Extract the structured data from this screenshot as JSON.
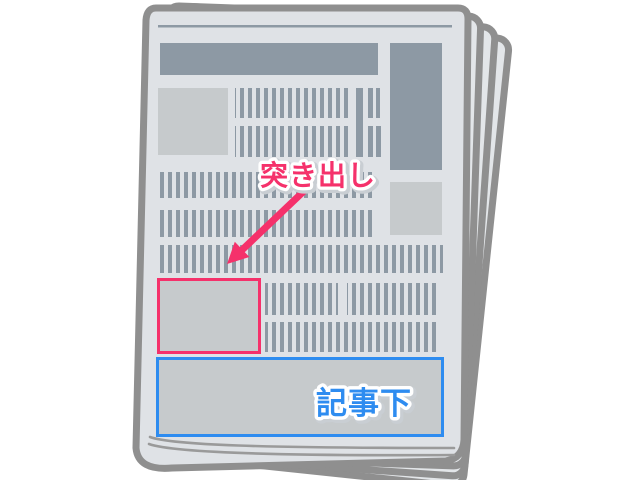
{
  "illustration": {
    "background_color": "#ffffff",
    "newspaper": {
      "paper_color": "#dfe2e6",
      "back_page_color": "#e3e6e9",
      "outline_color": "#8f8f8f",
      "ink_color": "#8d99a4",
      "image_block_color": "#c6cacc",
      "fold_line_color": "#9a9a9a"
    },
    "ad_slots": {
      "tsukidashi": {
        "label": "突き出し",
        "accent_color": "#f5316b",
        "label_outline_color": "#ffffff",
        "label_shadow_color": "#c9ced3"
      },
      "kijishita": {
        "label": "記事下",
        "accent_color": "#2e8cf0",
        "label_outline_color": "#ffffff",
        "label_shadow_color": "#c9ced3"
      }
    }
  }
}
